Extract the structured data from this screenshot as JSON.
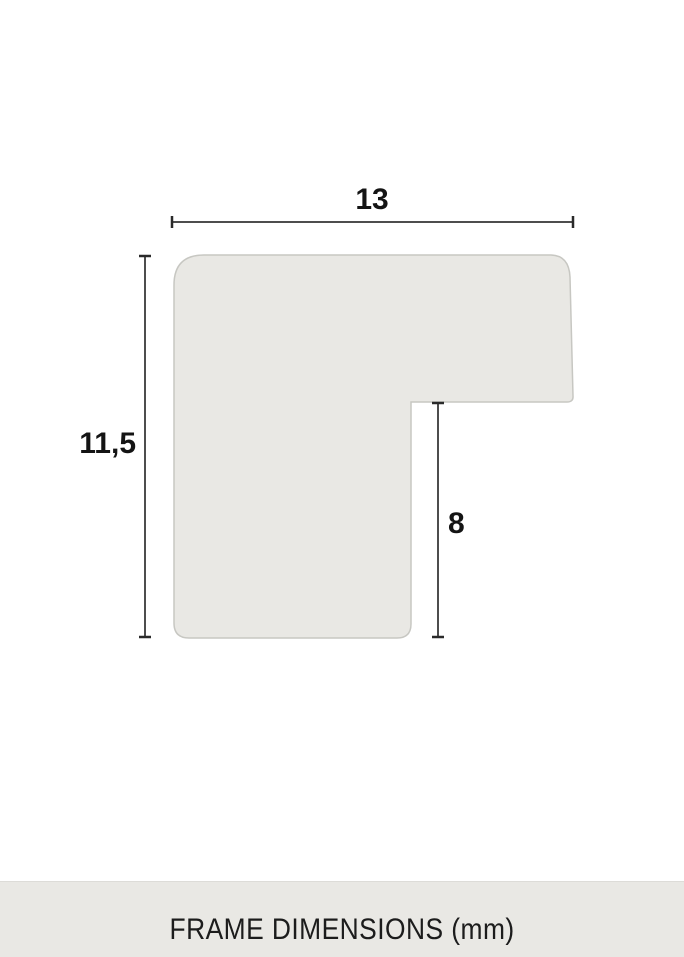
{
  "diagram": {
    "name": "frame-profile-cross-section",
    "unit": "mm",
    "labels": {
      "width": "13",
      "height": "11,5",
      "inner_height": "8"
    },
    "dimensions": {
      "width_mm": 13,
      "height_mm": 11.5,
      "inner_height_mm": 8
    }
  },
  "footer": {
    "caption": "FRAME DIMENSIONS (mm)"
  },
  "colors": {
    "page_background": "#ffffff",
    "shape_fill": "#e9e8e4",
    "shape_border": "#c7c7c2",
    "dimension_line": "#4d4d4d",
    "dimension_cap": "#2a2a2a",
    "label_text": "#141414",
    "footer_bg": "#e9e8e4",
    "footer_text": "#1c1c1c"
  }
}
